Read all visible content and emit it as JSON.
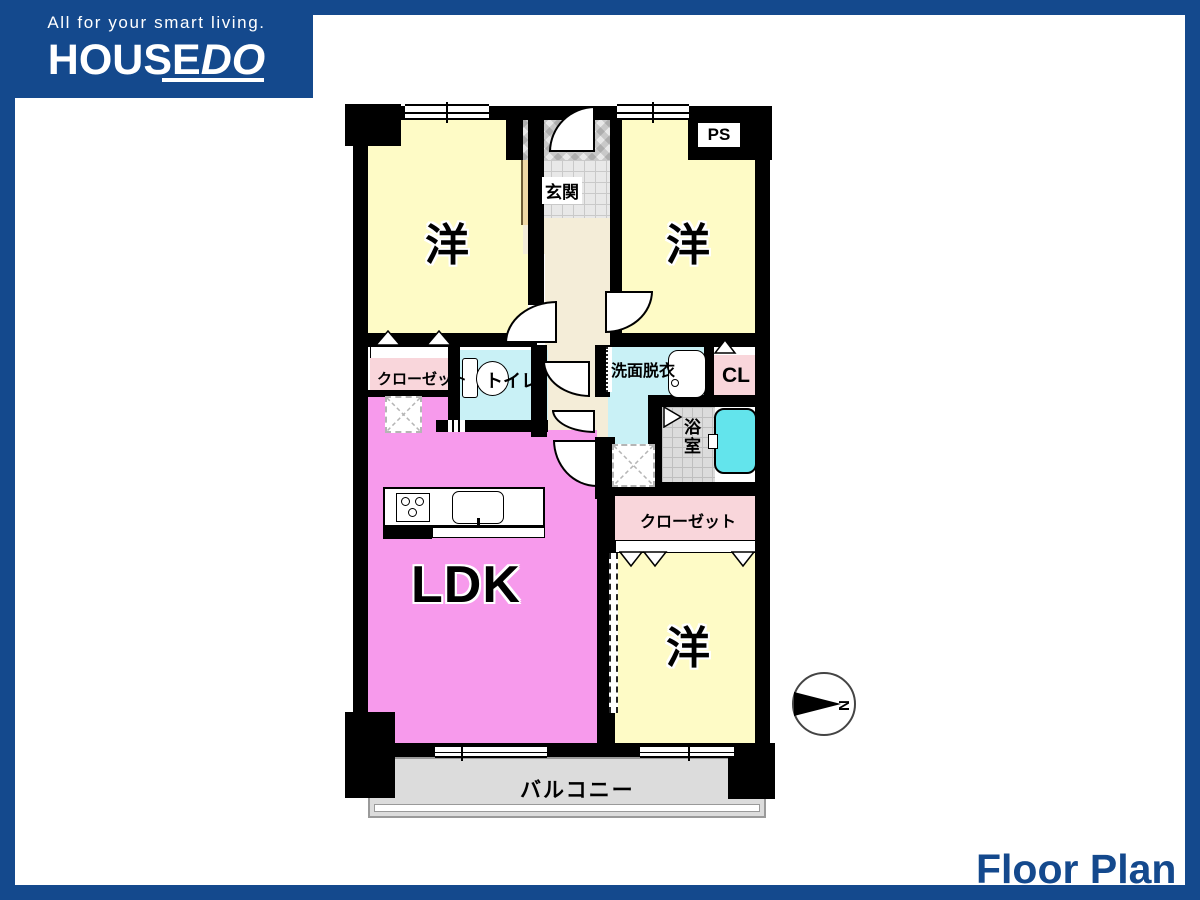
{
  "brand": {
    "tagline": "All for your smart living.",
    "name_main": "HOUSE",
    "name_accent": "DO"
  },
  "footer": {
    "title": "Floor Plan"
  },
  "plan": {
    "rooms": {
      "bedroom_top_left": "洋",
      "bedroom_top_right": "洋",
      "bedroom_bottom_right": "洋",
      "ldk": "LDK",
      "entrance": "玄関",
      "toilet": "トイレ",
      "washroom": "洗面脱衣",
      "bathroom": "浴室",
      "closet_left": "クローゼット",
      "closet_right": "クローゼット",
      "closet_cl": "CL",
      "pipe_space": "PS",
      "balcony": "バルコニー"
    },
    "compass_label": "N"
  },
  "colors": {
    "brand_blue": "#14498d",
    "bedroom_yellow": "#fefbc6",
    "ldk_pink": "#f79aec",
    "closet_pink": "#f9d6db",
    "water_cyan": "#c9f1f6",
    "bathtub_cyan": "#63e4ec",
    "hall_cream": "#f4edd8",
    "balcony_gray": "#dcdcdc",
    "wall_black": "#000000"
  }
}
